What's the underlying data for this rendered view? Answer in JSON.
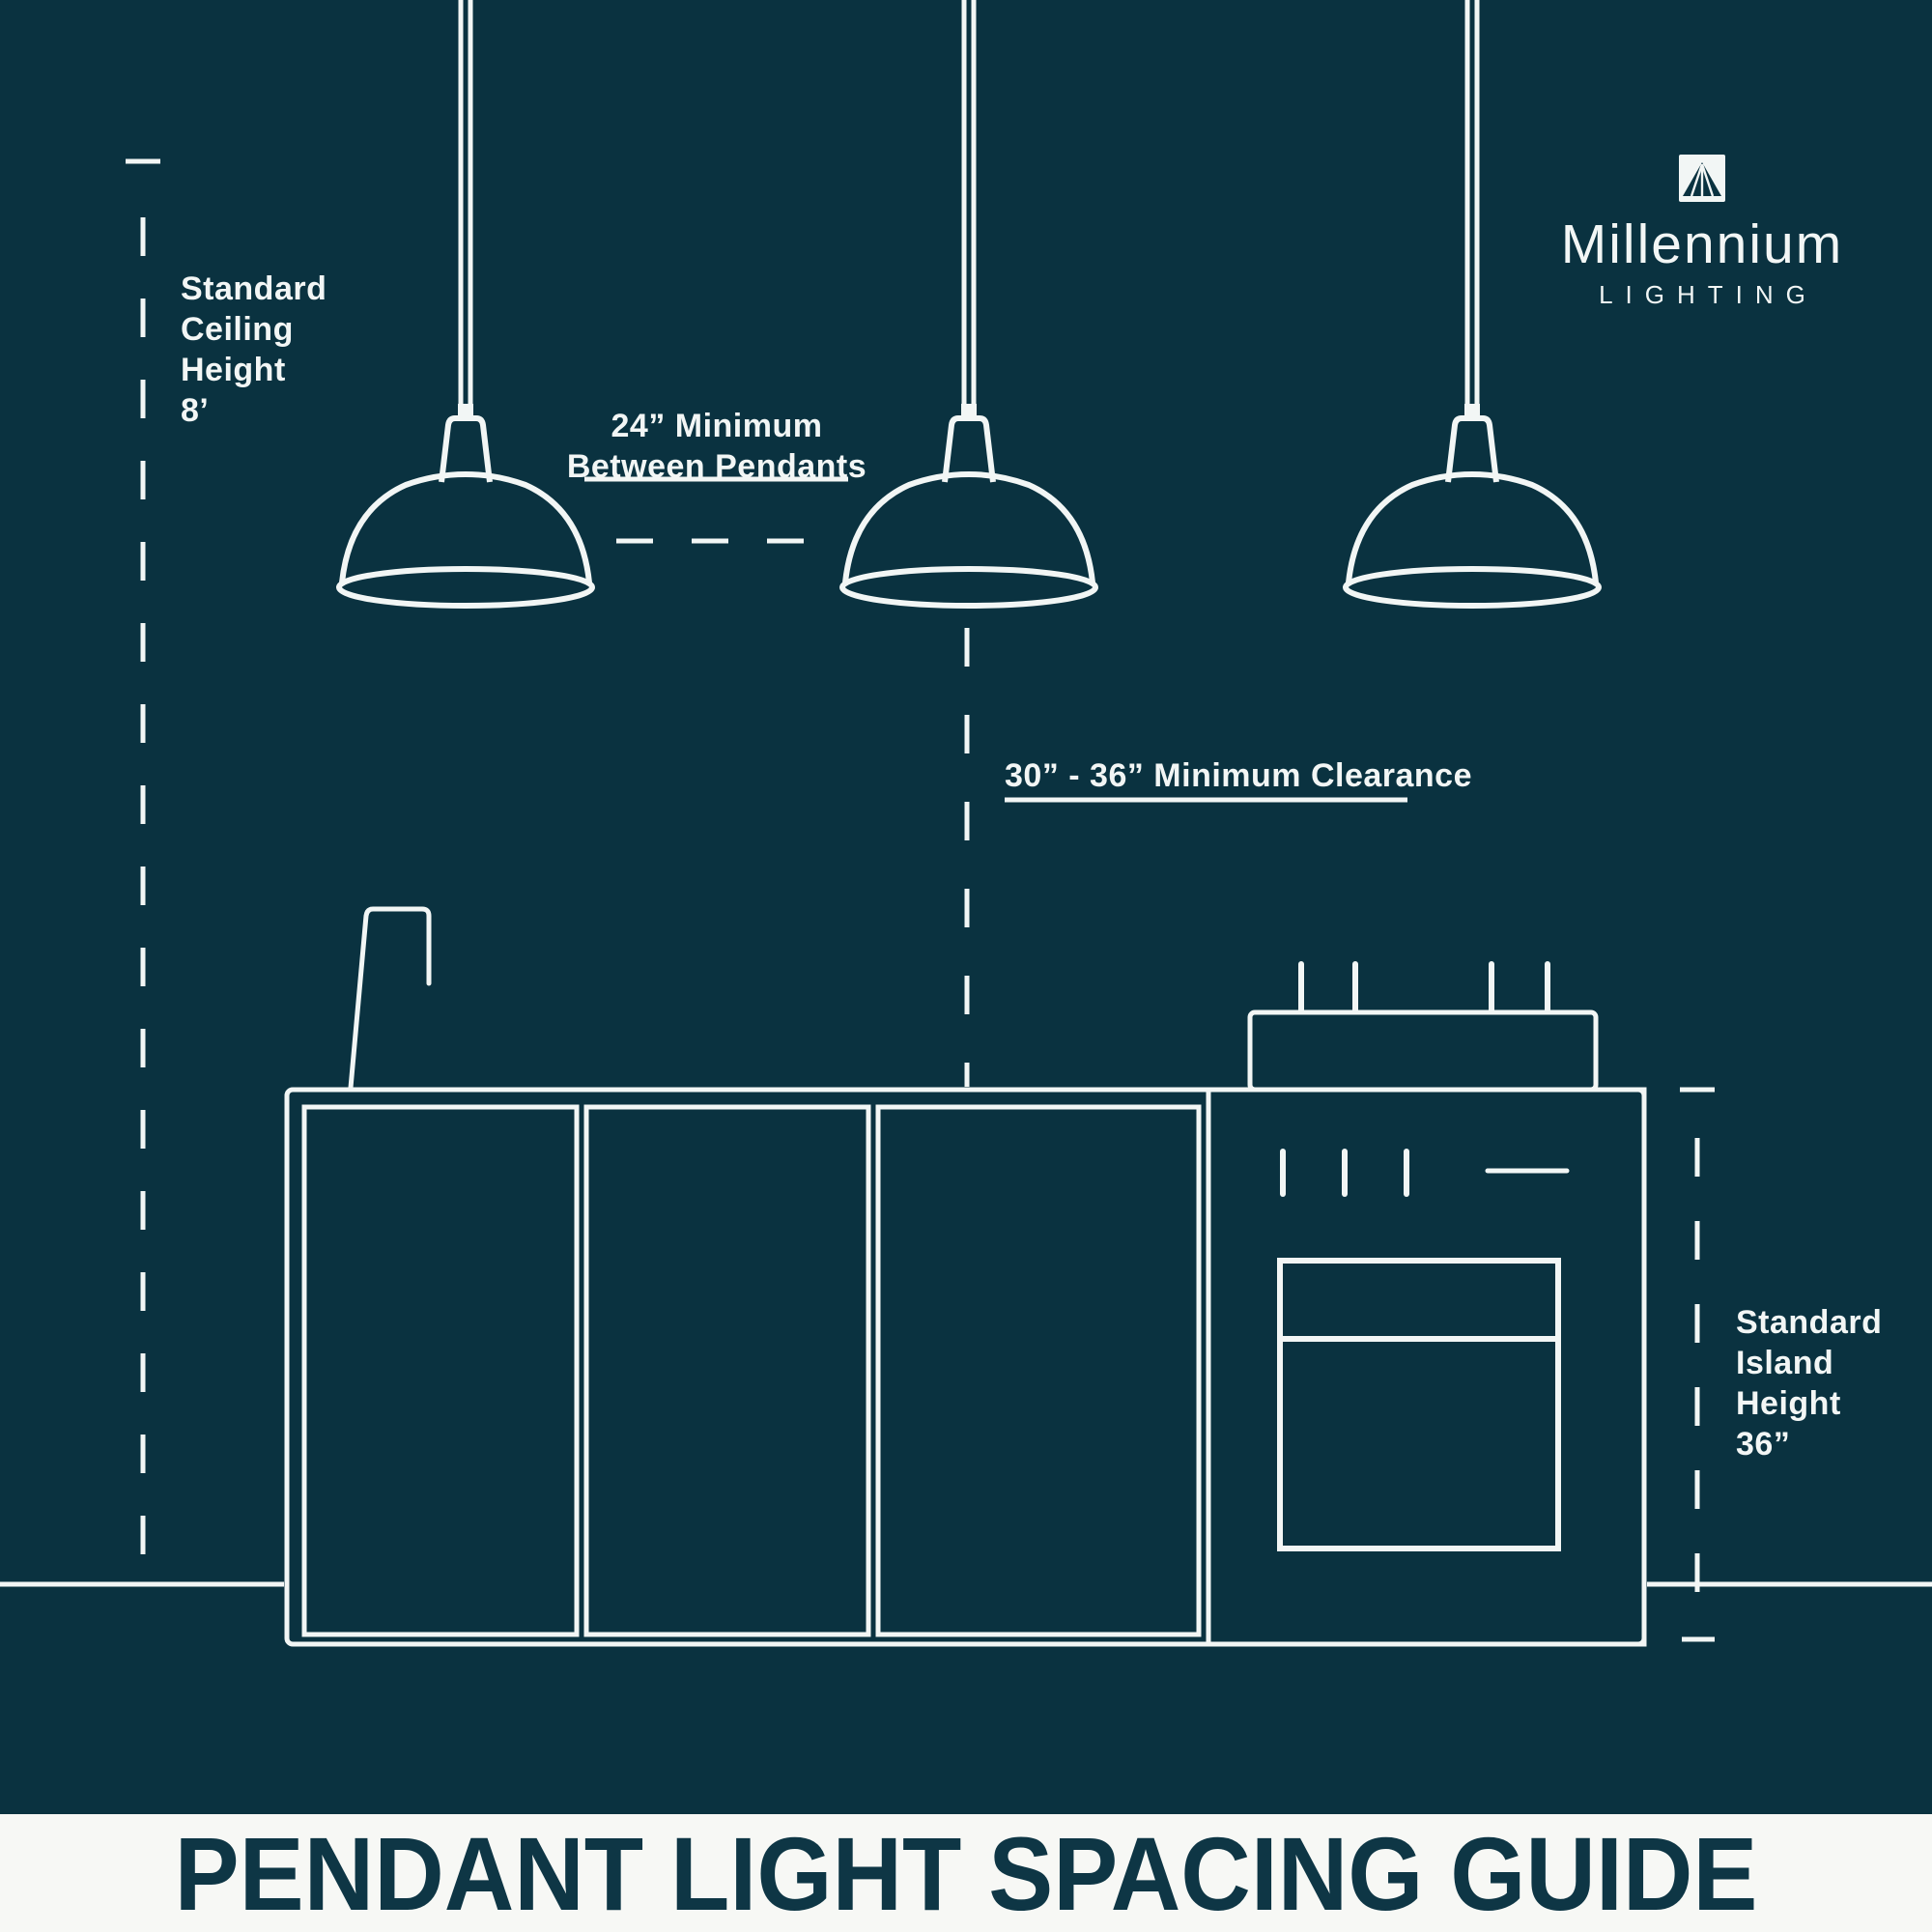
{
  "colors": {
    "background": "#0A3240",
    "line": "#F2F6F5",
    "banner_bg": "#F7F8F5",
    "banner_text": "#0E3645"
  },
  "logo": {
    "brand": "Millennium",
    "tagline": "LIGHTING"
  },
  "labels": {
    "ceiling_height": {
      "line1": "Standard",
      "line2": "Ceiling",
      "line3": "Height",
      "line4": "8’"
    },
    "pendant_spacing": {
      "line1": "24” Minimum",
      "line2": "Between Pendants"
    },
    "clearance": {
      "text": "30” - 36” Minimum Clearance"
    },
    "island_height": {
      "line1": "Standard",
      "line2": "Island",
      "line3": "Height",
      "line4": "36”"
    }
  },
  "diagram": {
    "pendant_count": 3,
    "ceiling_height": "8’",
    "min_between_pendants": "24”",
    "min_clearance": "30” - 36”",
    "island_height": "36”"
  },
  "footer": {
    "title": "PENDANT LIGHT SPACING GUIDE"
  },
  "icons": {
    "logo_icon": "millennium-beacon-icon"
  }
}
